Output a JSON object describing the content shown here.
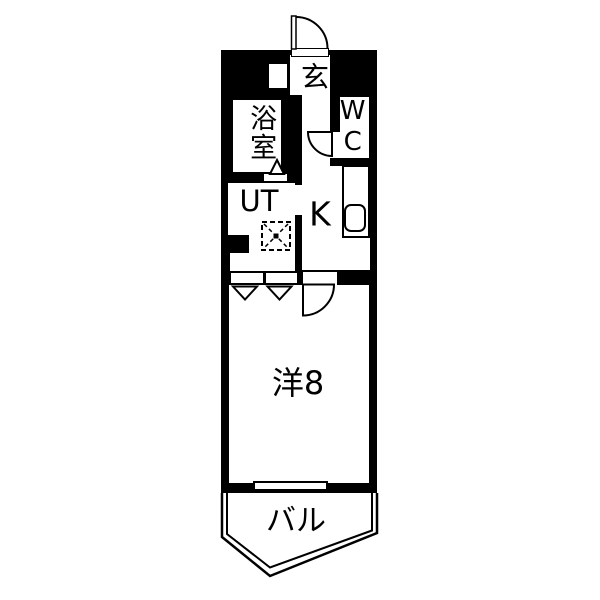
{
  "floorplan": {
    "type": "japanese-apartment-floorplan",
    "colors": {
      "walls": "#000000",
      "background": "#ffffff",
      "lines": "#000000"
    },
    "rooms": [
      {
        "id": "genkan",
        "label": "玄"
      },
      {
        "id": "bathroom",
        "label": "浴室"
      },
      {
        "id": "toilet",
        "label": "WC"
      },
      {
        "id": "utility",
        "label": "UT"
      },
      {
        "id": "kitchen",
        "label": "K"
      },
      {
        "id": "western-room",
        "label": "洋8"
      },
      {
        "id": "balcony",
        "label": "バル"
      }
    ],
    "symbols": [
      "entrance-door-arc",
      "wc-door-arc",
      "room-door-arc",
      "bathroom-folding-door-triangle",
      "closet-door-triangles",
      "washing-machine-pan",
      "kitchen-counter",
      "kitchen-sink",
      "shoe-cabinet",
      "window",
      "balcony-outline"
    ]
  }
}
